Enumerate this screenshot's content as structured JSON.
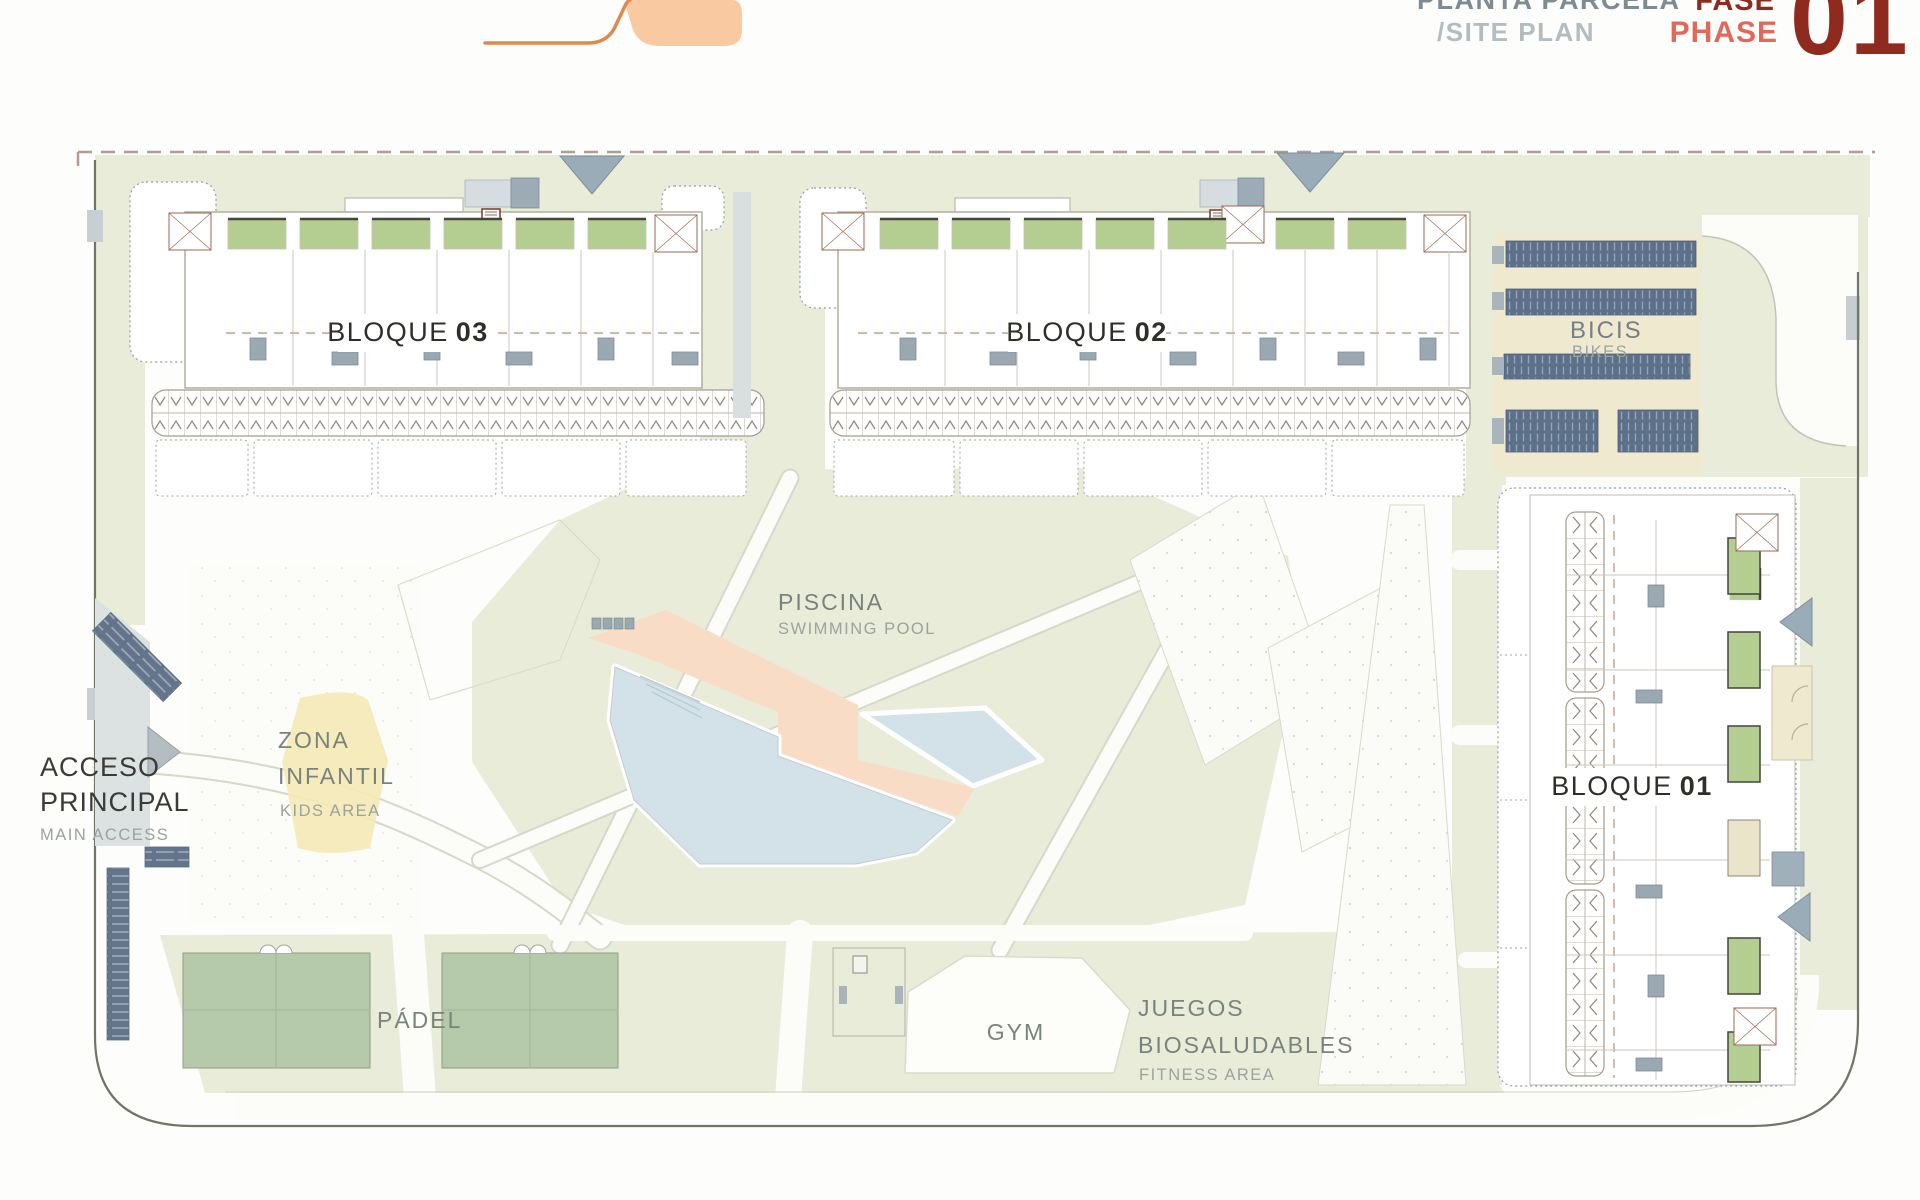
{
  "header": {
    "title": "PLANTA PARCELA",
    "subtitle": "/SITE PLAN",
    "phase_label_es": "FASE",
    "phase_label_en": "PHASE",
    "phase_number": "01"
  },
  "plan": {
    "blocks": [
      {
        "label": "BLOQUE",
        "number": "03"
      },
      {
        "label": "BLOQUE",
        "number": "02"
      },
      {
        "label": "BLOQUE",
        "number": "01"
      }
    ],
    "labels": {
      "bikes": {
        "title": "BICIS",
        "subtitle": "BIKES"
      },
      "pool": {
        "title": "PISCINA",
        "subtitle": "SWIMMING POOL"
      },
      "kids": {
        "line1": "ZONA",
        "line2": "INFANTIL",
        "subtitle": "KIDS AREA"
      },
      "access": {
        "line1": "ACCESO",
        "line2": "PRINCIPAL",
        "subtitle": "MAIN ACCESS"
      },
      "padel": {
        "title": "PÁDEL"
      },
      "gym": {
        "title": "GYM"
      },
      "fitness": {
        "line1": "JUEGOS",
        "line2": "BIOSALUDABLES",
        "subtitle": "FITNESS AREA"
      }
    },
    "colors": {
      "brand_dark_red": "#8f2a1e",
      "brand_salmon": "#e2685c",
      "logo_orange": "#f9c9a2",
      "logo_orange_line": "#e0894e",
      "landscape_green": "#e9ecd8",
      "court_green": "#b5c9ab",
      "garden_green": "#b4cd90",
      "pool_blue": "#d3e2e8",
      "deck_salmon": "#f8dcc5",
      "bike_rack_slate": "#5c7088",
      "kids_yellow": "#f4e9b5",
      "road_gray": "#dce1e2"
    }
  }
}
